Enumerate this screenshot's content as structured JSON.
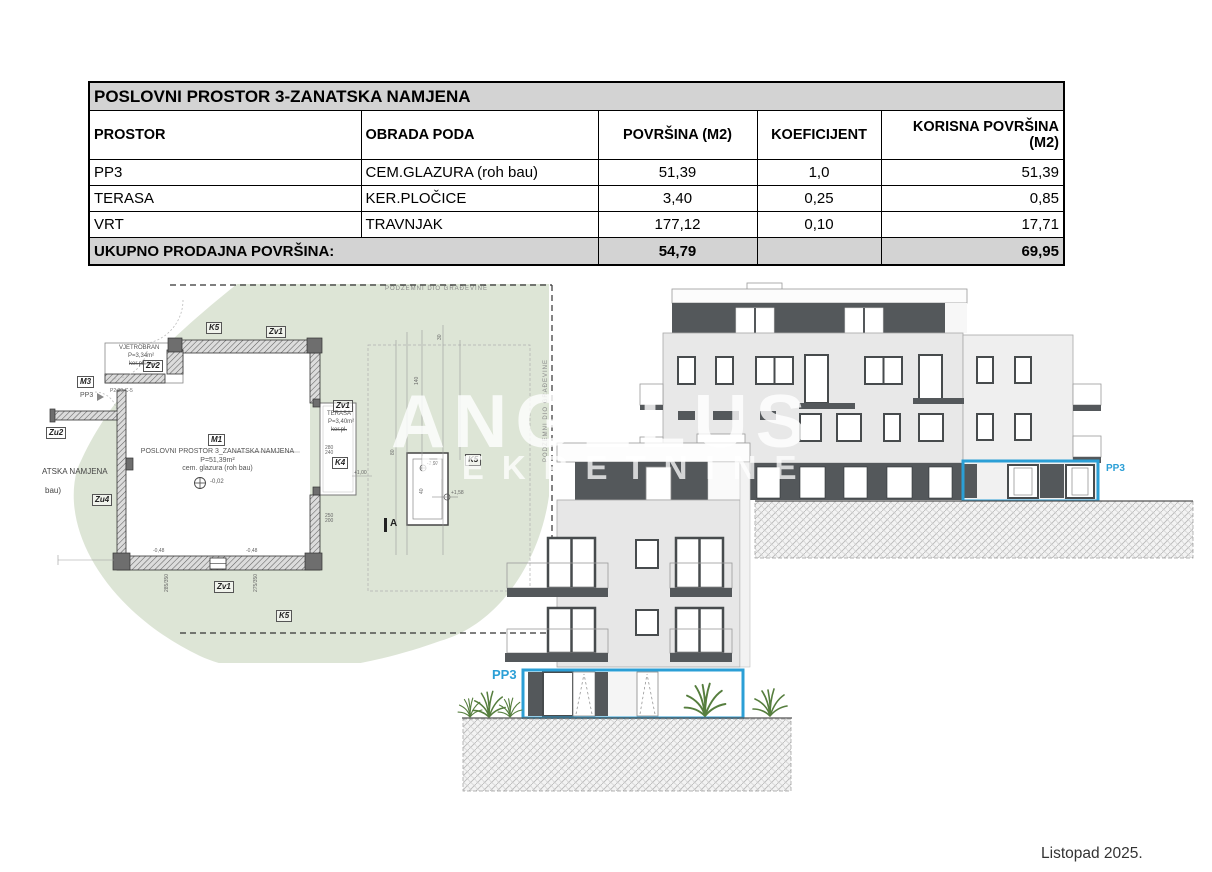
{
  "table": {
    "title": "POSLOVNI PROSTOR 3-ZANATSKA NAMJENA",
    "headers": [
      "PROSTOR",
      "OBRADA PODA",
      "POVRŠINA (M2)",
      "KOEFICIJENT",
      "KORISNA POVRŠINA (M2)"
    ],
    "rows": [
      {
        "prostor": "PP3",
        "obrada": "CEM.GLAZURA (roh bau)",
        "povrsina": "51,39",
        "koeficijent": "1,0",
        "korisna": "51,39"
      },
      {
        "prostor": "TERASA",
        "obrada": "KER.PLOČICE",
        "povrsina": "3,40",
        "koeficijent": "0,25",
        "korisna": "0,85"
      },
      {
        "prostor": "VRT",
        "obrada": "TRAVNJAK",
        "povrsina": "177,12",
        "koeficijent": "0,10",
        "korisna": "17,71"
      }
    ],
    "total": {
      "label": "UKUPNO PRODAJNA POVRŠINA:",
      "povrsina": "54,79",
      "korisna": "69,95"
    }
  },
  "plan": {
    "labels": {
      "underground_top": "PODZEMNI DIO GRAĐEVINE",
      "underground_right": "PODZEMNI DIO GRAĐEVINE",
      "k5_top": "K5",
      "zv1_top": "Zv1",
      "vjetrobran_name": "VJETROBRAN",
      "vjetrobran_area": "P=3,34m²",
      "vjetrobran_floor": "ker.pločice",
      "zv2": "Zv2",
      "m3": "M3",
      "pp3": "PP3",
      "p2_note": "P2 30-C-5",
      "zu2": "Zu2",
      "cut_text_1": "ATSKA NAMJENA",
      "cut_text_2": "bau)",
      "zu4": "Zu4",
      "m1": "M1",
      "m1_line1": "POSLOVNI PROSTOR 3_ZANATSKA NAMJENA",
      "m1_line2": "P=51,39m²",
      "m1_line3": "cem. glazura (roh bau)",
      "level_zero": "-0,02",
      "zv1_mid": "Zv1",
      "terasa_name": "TERASA",
      "terasa_area": "P=3,40m²",
      "terasa_floor": "ker.pl.",
      "k4": "K4",
      "level_100": "+1,00",
      "k5_mid": "K5",
      "level_m297": "-2,97",
      "level_158": "+1,58",
      "section_a": "A",
      "zv1_bottom": "Zv1",
      "k5_bottom": "K5"
    },
    "dims": {
      "w280_240": "280\n240",
      "w250_200": "250\n200",
      "n285_350": "285/350",
      "n275_350": "275/350",
      "l048a": "-0,48",
      "l048b": "-0,48",
      "d30": "30",
      "d140": "140",
      "d80": "80",
      "d40": "40"
    }
  },
  "elevations": {
    "front_pp3": "PP3",
    "rear_pp3": "PP3"
  },
  "watermark": {
    "line1": "ANGELUS",
    "line2": "NEKRETNINE"
  },
  "footer": {
    "date": "Listopad 2025."
  },
  "colors": {
    "highlight_blue": "#2b9fd6",
    "plan_green": "#dde5d6",
    "table_gray": "#d3d3d3",
    "dark_floor": "#54585b"
  }
}
